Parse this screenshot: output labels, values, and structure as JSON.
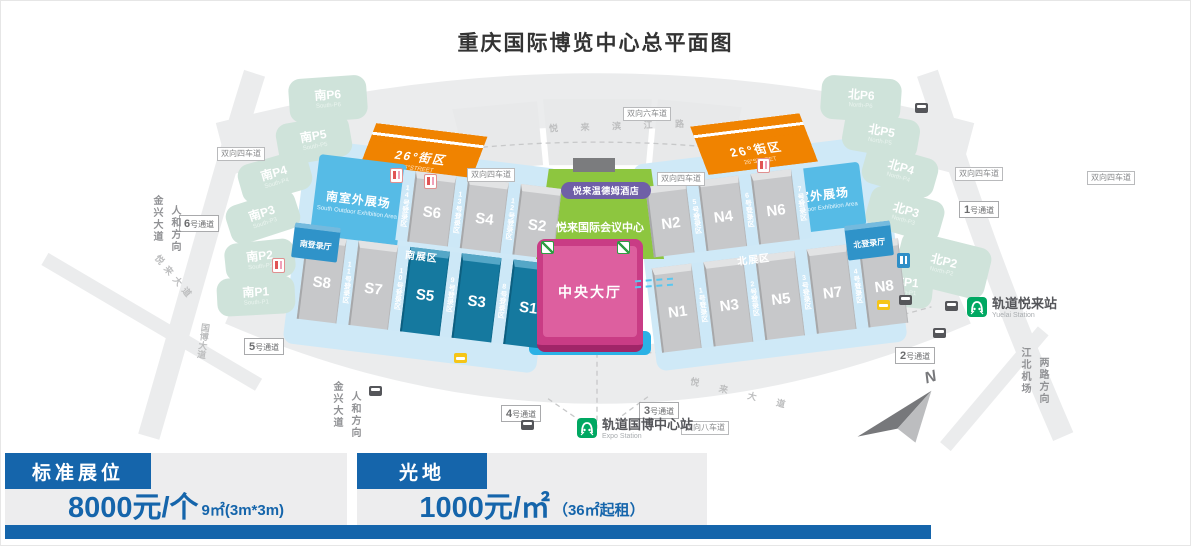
{
  "title": "重庆国际博览中心总平面图",
  "colors": {
    "accent_blue": "#1565ab",
    "orange": "#f08300",
    "green": "#8dc63f",
    "pink": "#c93c85",
    "hall_teal": "#15799f",
    "sky_blue": "#56bbe6",
    "metro_green": "#00a862"
  },
  "map": {
    "south_outdoor": {
      "label": "南室外展场",
      "en": "South Outdoor Exhibition Area"
    },
    "north_outdoor": {
      "label": "北室外展场",
      "en": "North Outdoor Exhibition Area"
    },
    "south_reg_hall": "南登录厅",
    "north_reg_hall": "北登录厅",
    "south_zone": "南展区",
    "north_zone": "北展区",
    "hotel": "悦来温德姆酒店",
    "conference": "悦来国际会议中心",
    "central_hall": "中央大厅",
    "street26_south": {
      "label": "26°街区",
      "en": "26°STREET"
    },
    "street26_north": {
      "label": "26°街区",
      "en": "26°STREET"
    },
    "compass_n": "N",
    "south_top": [
      {
        "cls": "strip",
        "label": "14号登录区"
      },
      {
        "cls": "hall",
        "label": "S6"
      },
      {
        "cls": "strip",
        "label": "13号登录区"
      },
      {
        "cls": "hall",
        "label": "S4"
      },
      {
        "cls": "strip",
        "label": "12号登录区"
      },
      {
        "cls": "hall",
        "label": "S2"
      }
    ],
    "south_bottom": [
      {
        "cls": "hall",
        "label": "S8"
      },
      {
        "cls": "strip",
        "label": "11号登录区"
      },
      {
        "cls": "hall",
        "label": "S7"
      },
      {
        "cls": "strip",
        "label": "10号登录区"
      },
      {
        "cls": "hall dark",
        "label": "S5"
      },
      {
        "cls": "strip",
        "label": "9号登录区"
      },
      {
        "cls": "hall dark",
        "label": "S3"
      },
      {
        "cls": "strip",
        "label": "8号登录区"
      },
      {
        "cls": "hall dark",
        "label": "S1"
      }
    ],
    "north_top": [
      {
        "cls": "hall",
        "label": "N2"
      },
      {
        "cls": "strip",
        "label": "5号登录区"
      },
      {
        "cls": "hall",
        "label": "N4"
      },
      {
        "cls": "strip",
        "label": "6号登录区"
      },
      {
        "cls": "hall",
        "label": "N6"
      },
      {
        "cls": "strip",
        "label": "7号登录区"
      }
    ],
    "north_bottom": [
      {
        "cls": "hall",
        "label": "N1"
      },
      {
        "cls": "strip",
        "label": "1号登录区"
      },
      {
        "cls": "hall",
        "label": "N3"
      },
      {
        "cls": "strip",
        "label": "2号登录区"
      },
      {
        "cls": "hall",
        "label": "N5"
      },
      {
        "cls": "strip",
        "label": "3号登录区"
      },
      {
        "cls": "hall",
        "label": "N7"
      },
      {
        "cls": "strip",
        "label": "4号登录区"
      },
      {
        "cls": "hall",
        "label": "N8"
      }
    ],
    "parking": [
      {
        "label": "南P6",
        "en": "South-P6",
        "style": "left:288px;top:76px;width:78px;height:44px;transform:rotate(-4deg)"
      },
      {
        "label": "南P5",
        "en": "South-P5",
        "style": "left:276px;top:118px;width:74px;height:42px;transform:rotate(-10deg)"
      },
      {
        "label": "南P4",
        "en": "South-P4",
        "style": "left:238px;top:156px;width:72px;height:40px;transform:rotate(-16deg)"
      },
      {
        "label": "南P3",
        "en": "South-P3",
        "style": "left:226px;top:196px;width:72px;height:40px;transform:rotate(-18deg)"
      },
      {
        "label": "南P2",
        "en": "South-P2",
        "style": "left:224px;top:240px;width:70px;height:38px;transform:rotate(-6deg)"
      },
      {
        "label": "南P1",
        "en": "South-P1",
        "style": "left:216px;top:276px;width:78px;height:38px;transform:rotate(-3deg)"
      },
      {
        "label": "北P6",
        "en": "North-P6",
        "style": "left:820px;top:76px;width:80px;height:44px;transform:rotate(4deg)"
      },
      {
        "label": "北P5",
        "en": "North-P5",
        "style": "left:842px;top:114px;width:76px;height:40px;transform:rotate(10deg)"
      },
      {
        "label": "北P4",
        "en": "North-P4",
        "style": "left:862px;top:150px;width:74px;height:40px;transform:rotate(16deg)"
      },
      {
        "label": "北P3",
        "en": "North-P3",
        "style": "left:866px;top:192px;width:76px;height:42px;transform:rotate(16deg)"
      },
      {
        "label": "北P2",
        "en": "North-P2",
        "style": "left:896px;top:238px;width:92px;height:52px;transform:rotate(14deg)"
      },
      {
        "label": "北P1",
        "en": "North-P1",
        "style": "left:876px;top:264px;width:56px;height:42px;transform:rotate(6deg)"
      }
    ],
    "gates": [
      {
        "n": "6",
        "s": "号通道",
        "style": "left:178px;top:214px"
      },
      {
        "n": "5",
        "s": "号通道",
        "style": "left:243px;top:337px"
      },
      {
        "n": "4",
        "s": "号通道",
        "style": "left:500px;top:404px"
      },
      {
        "n": "3",
        "s": "号通道",
        "style": "left:638px;top:401px"
      },
      {
        "n": "2",
        "s": "号通道",
        "style": "left:894px;top:346px"
      },
      {
        "n": "1",
        "s": "号通道",
        "style": "left:958px;top:200px"
      }
    ],
    "lanes": [
      {
        "label": "双向四车道",
        "style": "left:216px;top:146px"
      },
      {
        "label": "双向六车道",
        "style": "left:622px;top:106px"
      },
      {
        "label": "双向四车道",
        "style": "left:466px;top:167px"
      },
      {
        "label": "双向四车道",
        "style": "left:656px;top:171px"
      },
      {
        "label": "双向四车道",
        "style": "left:954px;top:166px"
      },
      {
        "label": "双向四车道",
        "style": "left:1086px;top:170px"
      },
      {
        "label": "双向八车道",
        "style": "left:680px;top:420px"
      }
    ],
    "vtexts": [
      {
        "a": "金兴大道",
        "b": "人和方向",
        "style": "left:148px;top:194px;height:76px"
      },
      {
        "a": "金兴大道",
        "b": "人和方向",
        "style": "left:328px;top:380px;height:66px"
      },
      {
        "a": "江北机场",
        "b": "两路方向",
        "style": "left:1016px;top:346px;height:66px"
      }
    ],
    "rnames": [
      {
        "label": "悦 来 滨 江 路",
        "style": "left:548px;top:118px;letter-spacing:10px;transform:rotate(-2deg)"
      },
      {
        "label": "国博大道",
        "style": "left:196px;top:322px;writing-mode:vertical-rl;text-orientation:upright;transform:rotate(8deg)"
      },
      {
        "label": "悦来大道",
        "style": "left:146px;top:270px;transform:rotate(50deg);letter-spacing:5px"
      },
      {
        "label": "悦 来 大 道",
        "style": "left:688px;top:386px;transform:rotate(14deg);letter-spacing:9px"
      }
    ],
    "stations": {
      "expo": {
        "cn": "轨道国博中心站",
        "en": "Expo Station"
      },
      "yuelai": {
        "cn": "轨道悦来站",
        "en": "Yuelai Station"
      }
    },
    "buses": [
      {
        "style": "left:368px;top:385px"
      },
      {
        "style": "left:520px;top:419px"
      },
      {
        "style": "left:914px;top:102px"
      },
      {
        "style": "left:898px;top:294px"
      },
      {
        "style": "left:944px;top:300px"
      },
      {
        "style": "left:932px;top:327px"
      }
    ],
    "taxis": [
      {
        "style": "left:453px;top:352px"
      },
      {
        "style": "left:876px;top:299px"
      }
    ],
    "toilets": [
      {
        "cls": "",
        "style": "left:389px;top:167px"
      },
      {
        "cls": "",
        "style": "left:423px;top:173px"
      },
      {
        "cls": "",
        "style": "left:756px;top:157px"
      },
      {
        "cls": "",
        "style": "left:271px;top:257px"
      },
      {
        "cls": "blue",
        "style": "left:896px;top:252px"
      }
    ]
  },
  "pricing": {
    "left": {
      "header": "标准展位",
      "price": "8000元/个",
      "note": "9㎡(3m*3m)"
    },
    "right": {
      "header": "光地",
      "price": "1000元/㎡",
      "note": "（36㎡起租）"
    }
  }
}
